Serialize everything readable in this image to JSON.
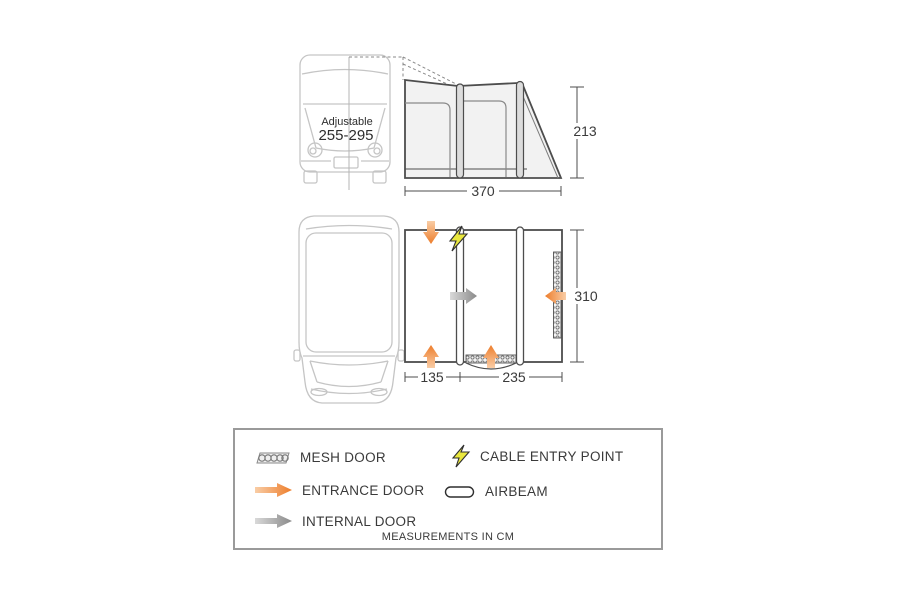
{
  "side_view": {
    "van_height_label": "Adjustable",
    "van_height_range": "255-295",
    "awning_length_cm": "370",
    "awning_height_cm": "213"
  },
  "floor_plan": {
    "awning_depth_cm": "310",
    "front_section_cm": "135",
    "main_section_cm": "235"
  },
  "legend": {
    "mesh_door": "MESH DOOR",
    "cable_entry_point": "CABLE ENTRY POINT",
    "entrance_door": "ENTRANCE DOOR",
    "airbeam": "AIRBEAM",
    "internal_door": "INTERNAL DOOR",
    "footnote": "MEASUREMENTS IN CM"
  },
  "icons": {
    "mesh_door": "mesh-pattern-strip",
    "cable_entry_point": "lightning-bolt",
    "entrance_door": "orange-gradient-arrow",
    "airbeam": "capsule-outline",
    "internal_door": "gray-gradient-arrow"
  },
  "colors": {
    "entrance_arrow": "#ed7d2b",
    "entrance_arrow_light": "#f9cda6",
    "internal_arrow": "#8a8a8a",
    "internal_arrow_light": "#d9d9d9",
    "cable_bolt": "#e9e73e",
    "outline_dark": "#4d4d4d",
    "van_outline": "#c5c5c5",
    "awning_fill": "#f2f2f2"
  }
}
